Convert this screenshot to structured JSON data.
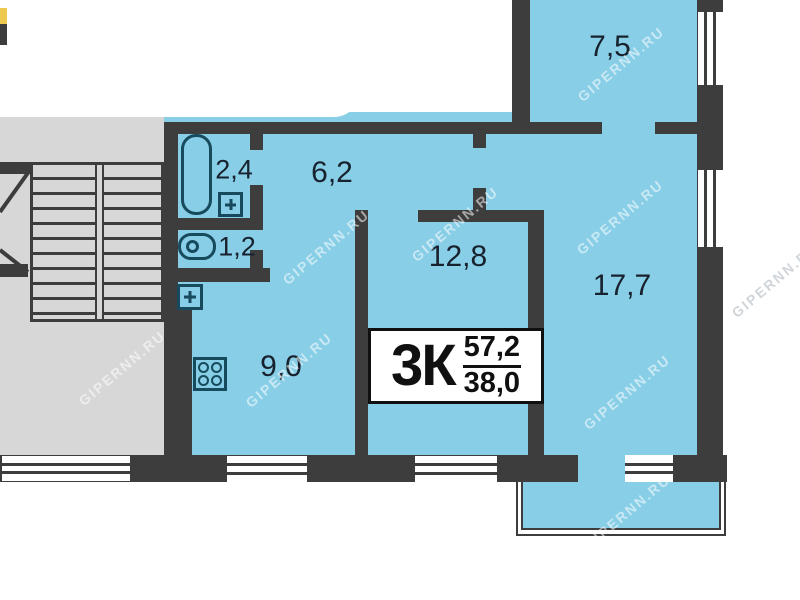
{
  "plan": {
    "watermark": "GIPERNN.RU",
    "info_box": {
      "type_label": "3К",
      "area_total": "57,2",
      "area_living": "38,0"
    },
    "rooms": {
      "top_room": "7,5",
      "hall": "6,2",
      "bath": "2,4",
      "wc": "1,2",
      "middle_room": "12,8",
      "right_room": "17,7",
      "kitchen": "9,0"
    },
    "colors": {
      "room_fill": "#87cee6",
      "wall": "#3d3d3d",
      "stairwell_fill": "#d7d7d7",
      "fixture_outline": "#174a5c",
      "balcony_fill": "#87cee6"
    }
  }
}
